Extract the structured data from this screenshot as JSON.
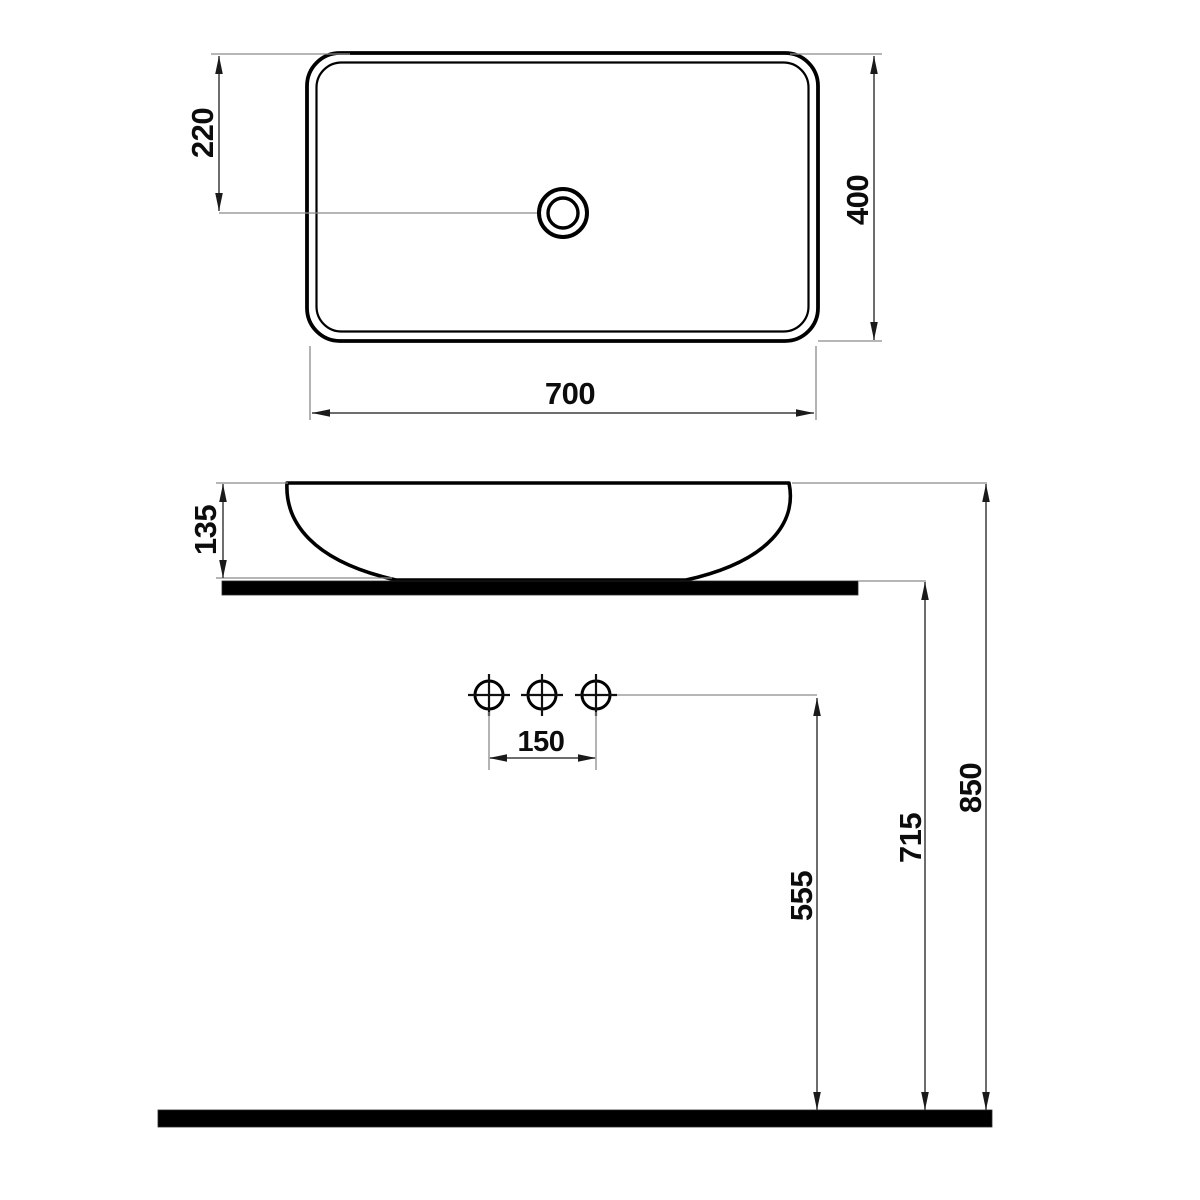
{
  "dimensions": {
    "basin_width": "700",
    "basin_depth": "400",
    "drain_offset": "220",
    "basin_height": "135",
    "faucet_hole_spacing": "150",
    "faucet_line_height": "555",
    "countertop_height": "715",
    "overall_height": "850"
  },
  "colors": {
    "object_line": "#000000",
    "dimension_line": "#3d3d3d",
    "extension_line": "#8a8a8a",
    "fill_bars": "#000000",
    "background": "#ffffff"
  }
}
